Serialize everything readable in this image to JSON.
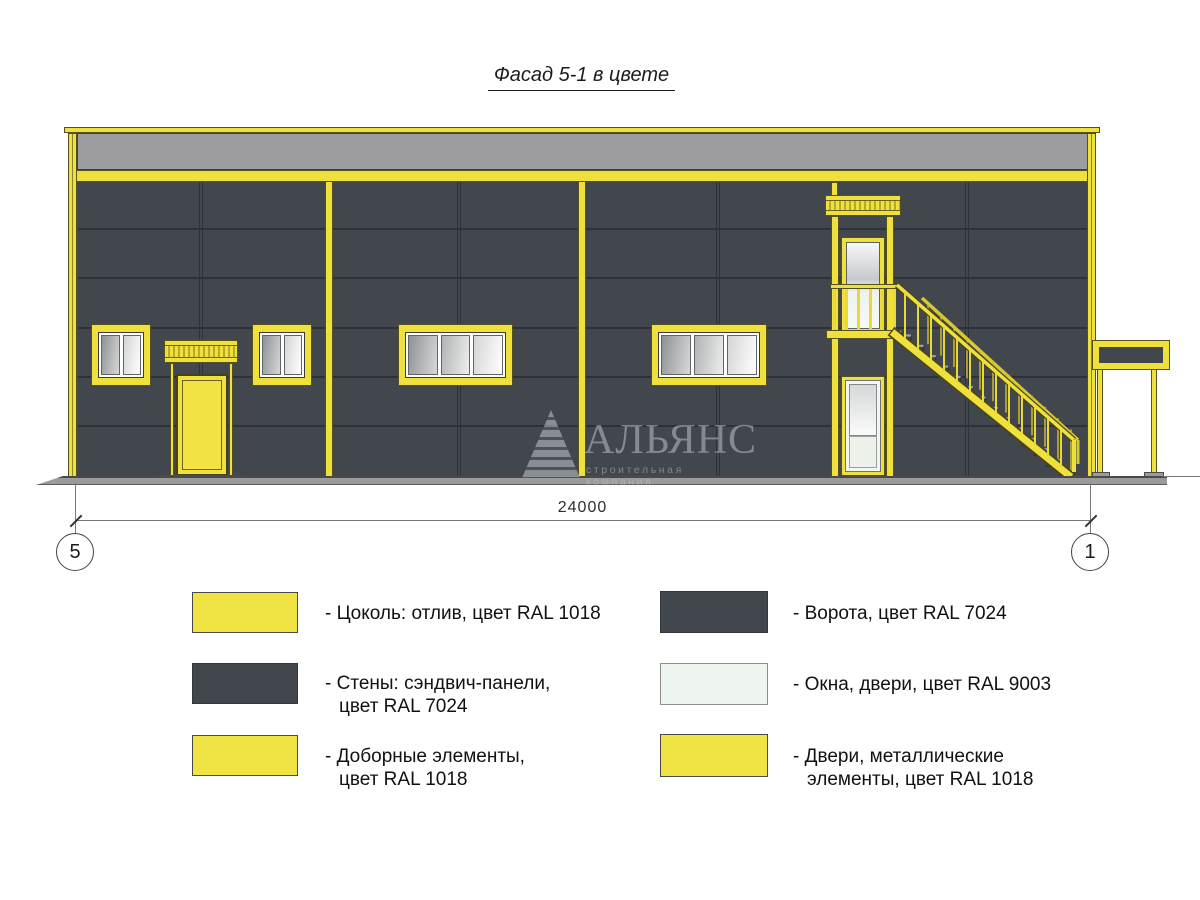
{
  "title": "Фасад 5-1 в цвете",
  "dimension": {
    "value": "24000",
    "axis_left": "5",
    "axis_right": "1"
  },
  "watermark": {
    "name": "АЛЬЯНС",
    "subtitle": "строительная компания"
  },
  "legend": {
    "left": [
      {
        "swatch": "#f0e344",
        "line1": "- Цоколь: отлив, цвет RAL 1018",
        "line2": ""
      },
      {
        "swatch": "#42464d",
        "line1": "- Стены: сэндвич-панели,",
        "line2": "цвет RAL 7024"
      },
      {
        "swatch": "#f0e344",
        "line1": "- Доборные элементы,",
        "line2": "цвет RAL 1018"
      }
    ],
    "right": [
      {
        "swatch": "#42464d",
        "line1": "- Ворота, цвет RAL 7024",
        "line2": ""
      },
      {
        "swatch": "#eef4ee",
        "line1": "- Окна, двери, цвет RAL 9003",
        "line2": ""
      },
      {
        "swatch": "#f0e344",
        "line1": "- Двери, металлические",
        "line2": "элементы, цвет RAL 1018"
      }
    ]
  },
  "colors": {
    "ral_1018_yellow": "#f0e03c",
    "ral_7024_gray": "#42464d",
    "ral_9003_white": "#eef4ee",
    "parapet_gray": "#9d9da0"
  }
}
